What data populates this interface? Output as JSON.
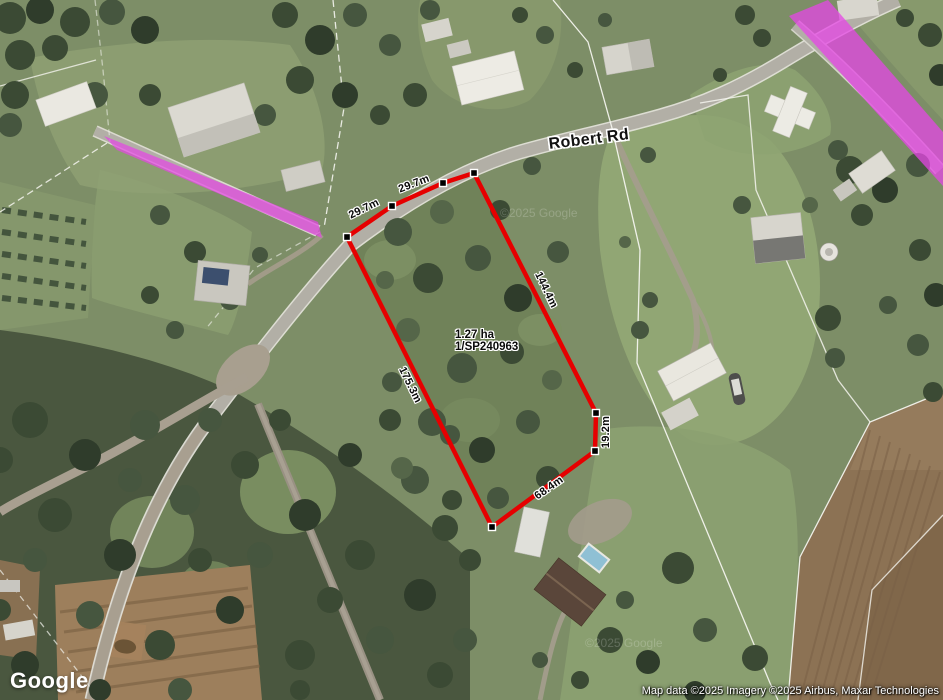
{
  "map_overlay": {
    "road_label": "Robert Rd",
    "watermark": "©2025 Google",
    "parcel": {
      "area": "1.27 ha",
      "lot_plan": "1/SP240963",
      "measurements": {
        "top_segment_1": "29.7m",
        "top_segment_2": "29.7m",
        "east_side": "144.4m",
        "east_side_lower": "19.2m",
        "south_side": "68.4m",
        "west_side": "175.3m"
      }
    }
  },
  "branding": {
    "logo_text": "Google"
  },
  "attribution": {
    "text": "Map data ©2025 Imagery ©2025 Airbus, Maxar Technologies"
  },
  "colors": {
    "parcel_boundary": "#e60000",
    "road_highlight": "#e545e5",
    "label_text": "#0a0a0a",
    "label_halo": "#ffffff"
  }
}
